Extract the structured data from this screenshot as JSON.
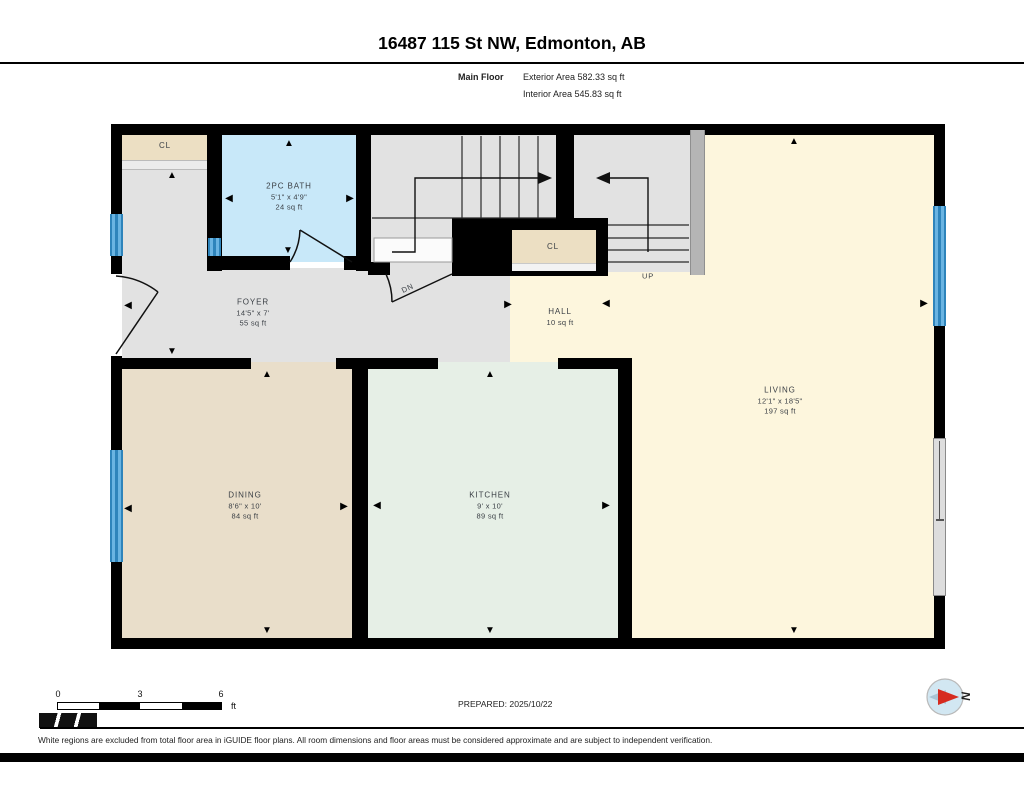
{
  "header": {
    "title": "16487 115 St NW, Edmonton, AB",
    "floor_label": "Main Floor",
    "exterior_area": "Exterior Area 582.33 sq ft",
    "interior_area": "Interior Area 545.83 sq ft"
  },
  "rooms": {
    "closet_top": {
      "name": "CL"
    },
    "bath": {
      "name": "2PC BATH",
      "dims": "5'1\" x 4'9\"",
      "area": "24 sq ft"
    },
    "foyer": {
      "name": "FOYER",
      "dims": "14'5\" x 7'",
      "area": "55 sq ft"
    },
    "closet_mid": {
      "name": "CL"
    },
    "hall": {
      "name": "HALL",
      "area": "10 sq ft"
    },
    "living": {
      "name": "LIVING",
      "dims": "12'1\" x 18'5\"",
      "area": "197 sq ft"
    },
    "dining": {
      "name": "DINING",
      "dims": "8'6\" x 10'",
      "area": "84 sq ft"
    },
    "kitchen": {
      "name": "KITCHEN",
      "dims": "9' x 10'",
      "area": "89 sq ft"
    }
  },
  "stairs": {
    "up_label": "UP",
    "down_label": "DN"
  },
  "scale_bar": {
    "tick_0": "0",
    "tick_3": "3",
    "tick_6": "6",
    "unit": "ft"
  },
  "footer": {
    "prepared": "PREPARED: 2025/10/22",
    "disclaimer": "White regions are excluded from total floor area in iGUIDE floor plans. All room dimensions and floor areas must be considered approximate and are subject to independent verification."
  },
  "compass": {
    "north_label": "N"
  },
  "icons": {
    "arrow_up": "▲",
    "arrow_down": "▼",
    "arrow_left": "◀",
    "arrow_right": "▶"
  },
  "colors": {
    "wall": "#000000",
    "foyer_floor": "#e2e2e2",
    "bath_floor": "#c8e8f9",
    "closet_floor": "#ecdfc3",
    "living_floor": "#fdf6dd",
    "dining_floor": "#e9deca",
    "kitchen_floor": "#e6efe6",
    "window": "#4aa0d5",
    "north_red": "#d62b1f"
  }
}
